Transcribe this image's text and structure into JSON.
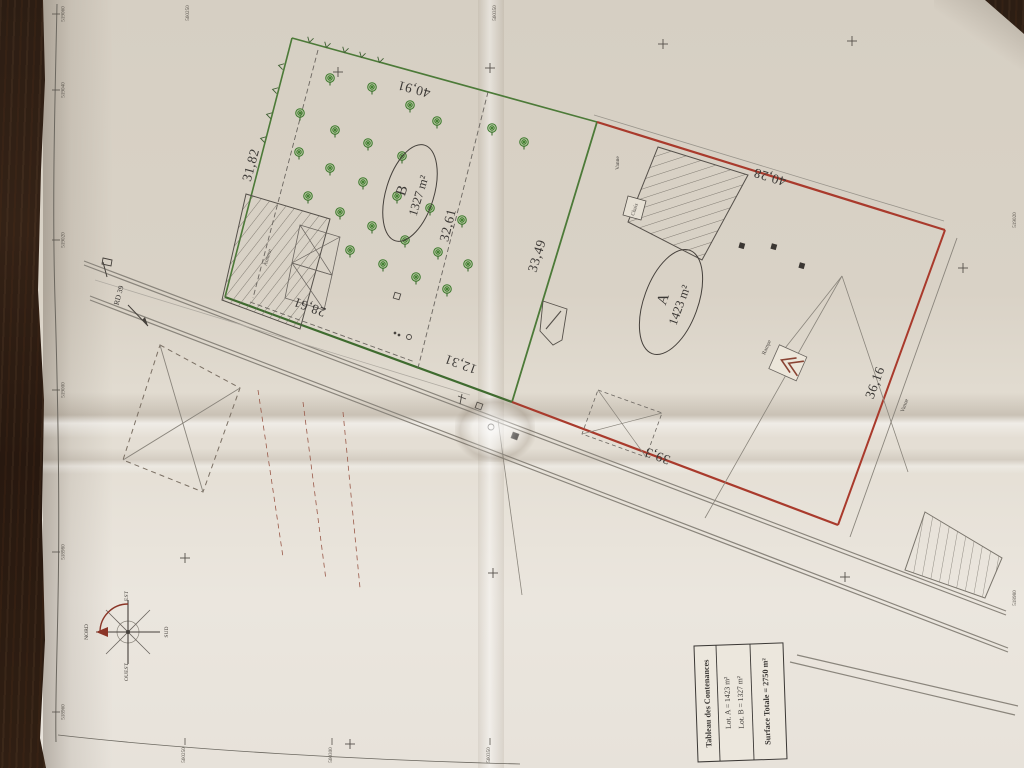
{
  "plan": {
    "title_block": {
      "header": "Tableau des Contenances",
      "row_a": "Lot. A = 1423 m²",
      "row_b": "Lot. B = 1327 m²",
      "total": "Surface Totale = 2750 m²"
    },
    "lots": [
      {
        "id": "A",
        "label": "A",
        "area": "1423 m²",
        "outline_color": "#a93a2c"
      },
      {
        "id": "B",
        "label": "B",
        "area": "1327 m²",
        "outline_color": "#4c7a38"
      }
    ],
    "measurements": [
      {
        "text": "40,91"
      },
      {
        "text": "31,82"
      },
      {
        "text": "32,61"
      },
      {
        "text": "33,49"
      },
      {
        "text": "28,61"
      },
      {
        "text": "12,31"
      },
      {
        "text": "40,28"
      },
      {
        "text": "36,16"
      },
      {
        "text": "39,3"
      }
    ],
    "road_label": "RD 39",
    "compass": {
      "directions": [
        "EST",
        "NORD",
        "OUEST",
        "SUD"
      ]
    },
    "small_labels": [
      {
        "text": "Annexe"
      },
      {
        "text": "Chais"
      },
      {
        "text": "Rampe"
      },
      {
        "text": "Vanne"
      },
      {
        "text": "Vanne"
      }
    ],
    "grid": {
      "left": [
        {
          "v": "519060",
          "y": 14
        },
        {
          "v": "519040",
          "y": 90
        },
        {
          "v": "519020",
          "y": 240
        },
        {
          "v": "519000",
          "y": 390
        },
        {
          "v": "518980",
          "y": 552
        },
        {
          "v": "518960",
          "y": 712
        }
      ],
      "top": [
        {
          "v": "560250",
          "x": 189
        },
        {
          "v": "560350",
          "x": 496
        }
      ],
      "bottom": [
        {
          "v": "560250",
          "x": 185
        },
        {
          "v": "560300",
          "x": 332
        },
        {
          "v": "560350",
          "x": 490
        }
      ],
      "right": [
        {
          "v": "519020",
          "y": 220
        },
        {
          "v": "518980",
          "y": 598
        }
      ]
    },
    "trees": [
      [
        330,
        78
      ],
      [
        372,
        87
      ],
      [
        410,
        105
      ],
      [
        437,
        121
      ],
      [
        300,
        113
      ],
      [
        335,
        130
      ],
      [
        368,
        143
      ],
      [
        402,
        156
      ],
      [
        299,
        152
      ],
      [
        330,
        168
      ],
      [
        363,
        182
      ],
      [
        397,
        196
      ],
      [
        430,
        208
      ],
      [
        462,
        220
      ],
      [
        308,
        196
      ],
      [
        340,
        212
      ],
      [
        372,
        226
      ],
      [
        405,
        240
      ],
      [
        438,
        252
      ],
      [
        468,
        264
      ],
      [
        350,
        250
      ],
      [
        383,
        264
      ],
      [
        416,
        277
      ],
      [
        447,
        289
      ],
      [
        492,
        128
      ],
      [
        524,
        142
      ]
    ],
    "crosses": [
      [
        338,
        72
      ],
      [
        490,
        68
      ],
      [
        663,
        44
      ],
      [
        852,
        41
      ],
      [
        963,
        268
      ],
      [
        185,
        558
      ],
      [
        493,
        573
      ],
      [
        845,
        577
      ],
      [
        350,
        744
      ]
    ],
    "hedge_marks": {
      "top": [
        {
          "x": 310,
          "y": 40
        },
        {
          "x": 327,
          "y": 45
        },
        {
          "x": 345,
          "y": 50
        },
        {
          "x": 362,
          "y": 55
        },
        {
          "x": 380,
          "y": 60
        }
      ],
      "left": [
        {
          "x": 281,
          "y": 66
        },
        {
          "x": 275,
          "y": 90
        },
        {
          "x": 269,
          "y": 115
        },
        {
          "x": 263,
          "y": 139
        }
      ]
    }
  }
}
